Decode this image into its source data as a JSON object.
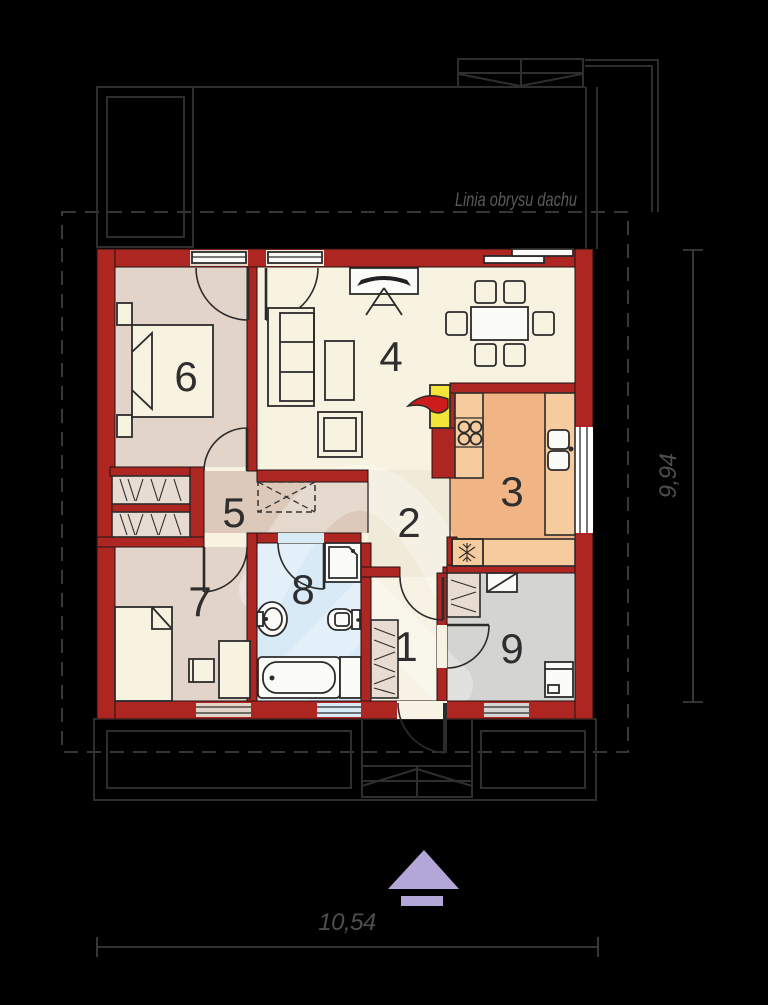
{
  "labels": {
    "roof_outline": "Linia obrysu dachu",
    "width_dimension": "10,54",
    "height_dimension": "9,94"
  },
  "rooms": [
    {
      "number": "1"
    },
    {
      "number": "2"
    },
    {
      "number": "3"
    },
    {
      "number": "4"
    },
    {
      "number": "5"
    },
    {
      "number": "6"
    },
    {
      "number": "7"
    },
    {
      "number": "8"
    },
    {
      "number": "9"
    }
  ],
  "icons": {
    "fridge": "snowflake-icon",
    "boiler": "flame-icon",
    "entrance": "arrow-up-icon"
  },
  "colors": {
    "wall": "#ad2621",
    "bedroom_floor": "#e3d4ca",
    "hallway_floor": "#dcc9b9",
    "living_floor": "#f8f2e1",
    "corridor_floor": "#f0ead9",
    "entry_floor": "#f7f2e4",
    "kitchen_floor": "#f1b585",
    "kitchen_counter": "#f6cb9e",
    "bathroom_floor": "#d9eaf7",
    "fixture_white": "#fbfbf8",
    "utility_floor": "#d4d4d2",
    "boiler_yellow": "#f4e53a",
    "flame_red": "#cc1c1c",
    "arrow_purple": "#b2a7d7",
    "site_line": "#2e2e2e",
    "dash_line": "#3e3e3e",
    "dim_line": "#434343",
    "dim_text": "#4e4e4e",
    "roof_text": "#5a5a5a",
    "number_text": "#2e2e2e",
    "wardrobe_fill": "#e8dcd2",
    "window_white": "#ffffff"
  }
}
